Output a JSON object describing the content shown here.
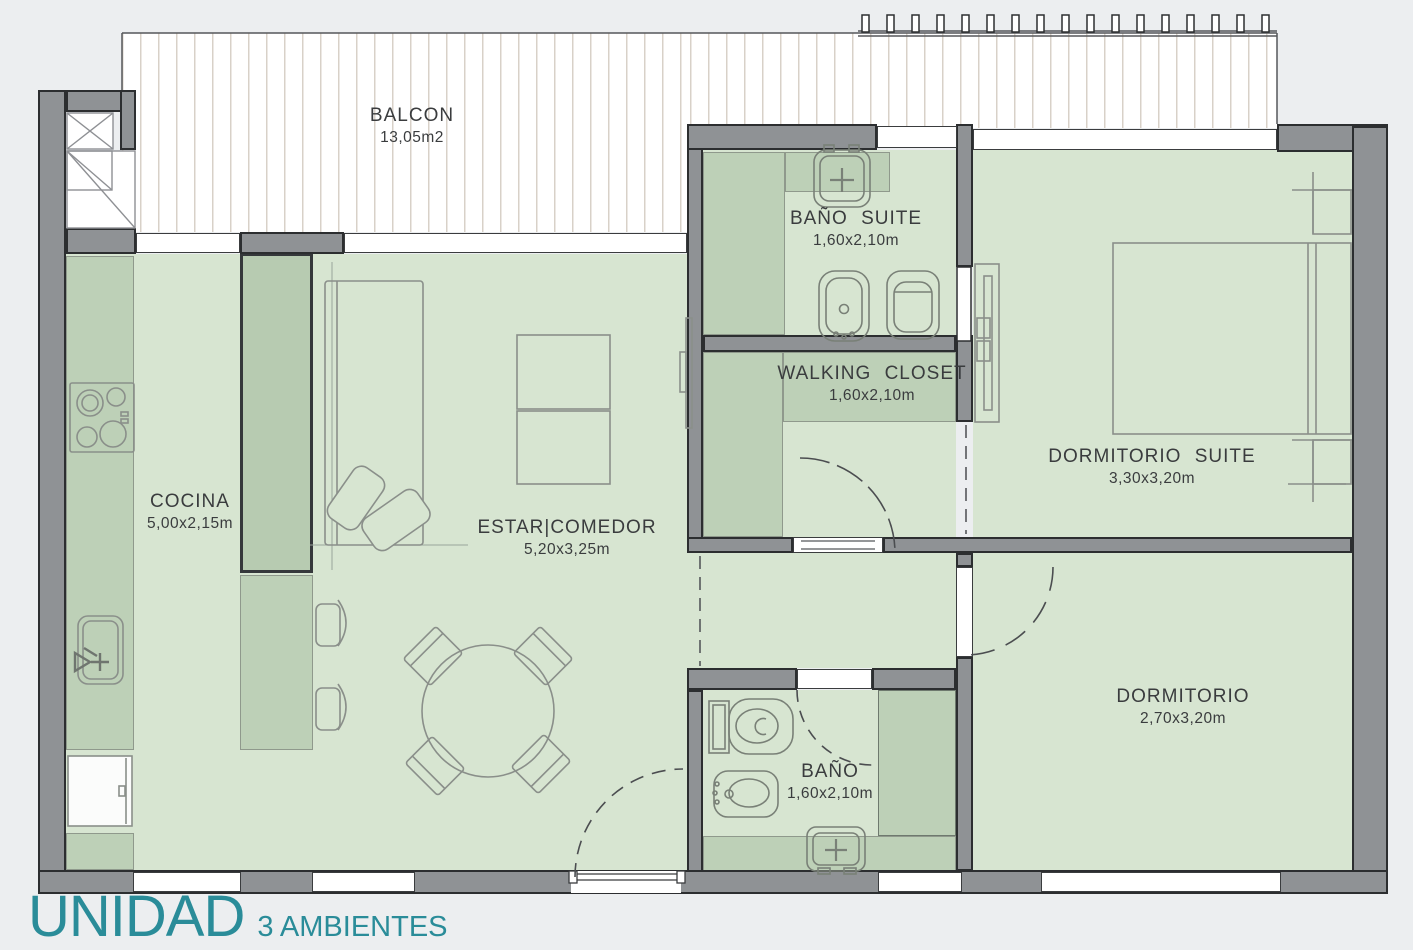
{
  "unit": {
    "title": "UNIDAD",
    "subtitle": "3 AMBIENTES"
  },
  "rooms": {
    "balcon": {
      "name": "BALCON",
      "size": "13,05m2"
    },
    "cocina": {
      "name": "COCINA",
      "size": "5,00x2,15m"
    },
    "estar_comedor": {
      "name": "ESTAR|COMEDOR",
      "size": "5,20x3,25m"
    },
    "bano_suite": {
      "name": "BAÑO SUITE",
      "size": "1,60x2,10m"
    },
    "walking_closet": {
      "name": "WALKING CLOSET",
      "size": "1,60x2,10m"
    },
    "dormitorio_suite": {
      "name": "DORMITORIO SUITE",
      "size": "3,30x3,20m"
    },
    "dormitorio": {
      "name": "DORMITORIO",
      "size": "2,70x3,20m"
    },
    "bano": {
      "name": "BAÑO",
      "size": "1,60x2,10m"
    }
  },
  "colors": {
    "accent_teal": "#2a8c99",
    "floor_green": "#d7e5d1",
    "counter_green": "#bdd0b7",
    "wall_gray": "#8f9295"
  }
}
